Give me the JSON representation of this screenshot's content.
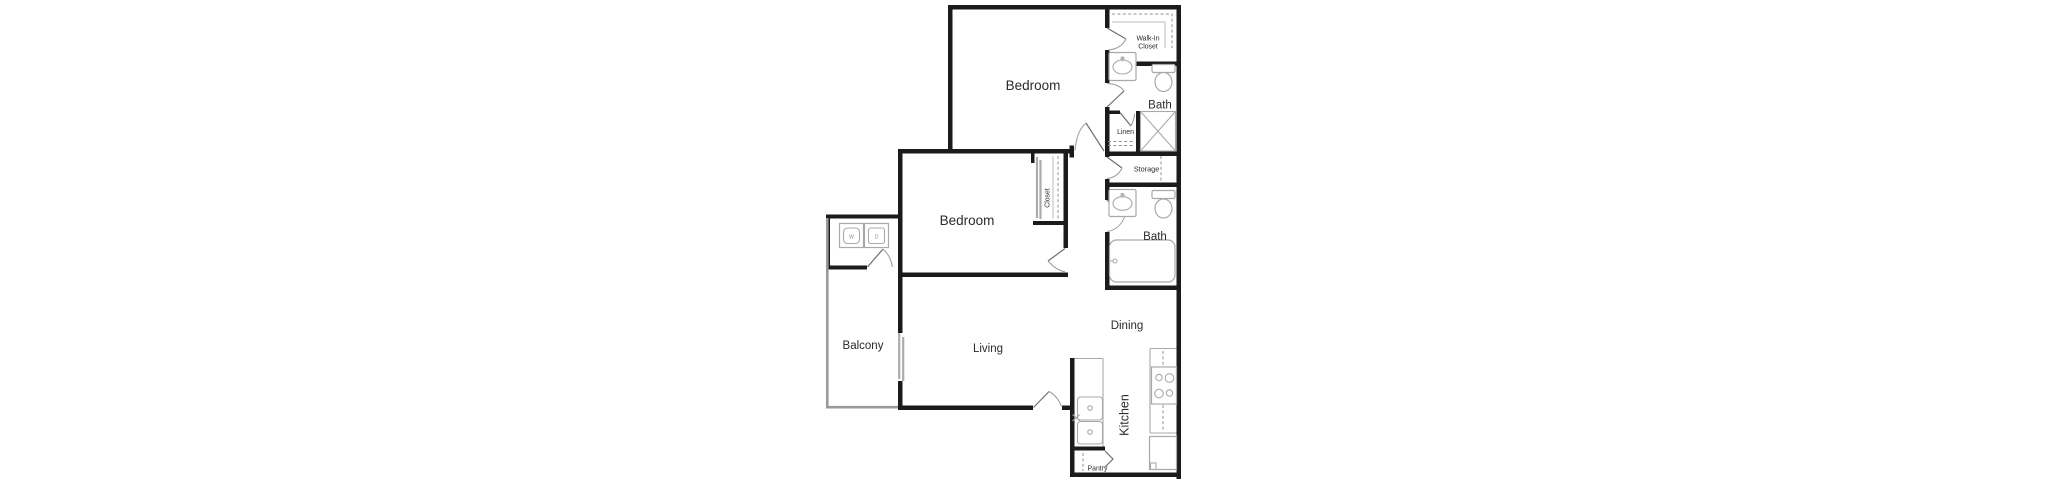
{
  "document": {
    "type": "apartment-floor-plan",
    "background": "#ffffff",
    "colors": {
      "wall": "#1b1b1b",
      "fixture_outline": "#a9a9a9",
      "balcony_railing": "#9a9a9a",
      "dashed_shelf": "#8f8f8f",
      "label_text": "#2b2b2b"
    }
  },
  "floor_plan": {
    "rooms": {
      "bedroom_1": "Bedroom",
      "walk_in_closet_line_1": "Walk-In",
      "walk_in_closet_line_2": "Closet",
      "bath_1": "Bath",
      "linen": "Linen",
      "storage": "Storage",
      "closet": "Closet",
      "bedroom_2": "Bedroom",
      "bath_2": "Bath",
      "balcony": "Balcony",
      "living": "Living",
      "dining": "Dining",
      "kitchen": "Kitchen",
      "pantry": "Pantry"
    },
    "appliances": {
      "washer": "W",
      "dryer": "D"
    },
    "fixtures": [
      "bathroom-sink",
      "toilet",
      "shower",
      "bathtub",
      "kitchen-double-sink",
      "stove",
      "refrigerator",
      "washer",
      "dryer"
    ]
  }
}
